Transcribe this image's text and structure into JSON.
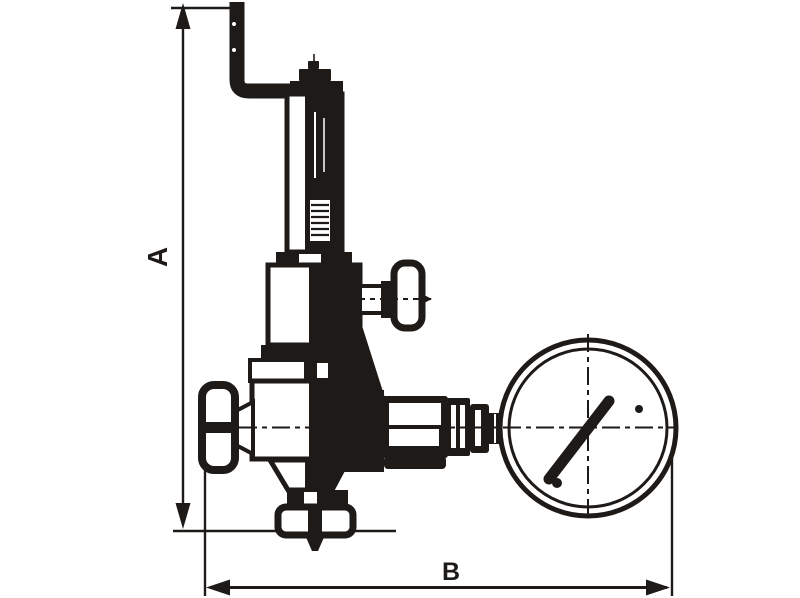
{
  "diagram": {
    "description": "Technical outline drawing of a bronze safety/pressure-reducing valve assembly with relief lever, spring housing, two handwheels, outlet flange and a pressure gauge, annotated with overall height and width dimension arrows",
    "ink_color": "#1e1a17",
    "background_color": "#ffffff",
    "dimension_labels": {
      "vertical": "A",
      "horizontal": "B"
    }
  }
}
